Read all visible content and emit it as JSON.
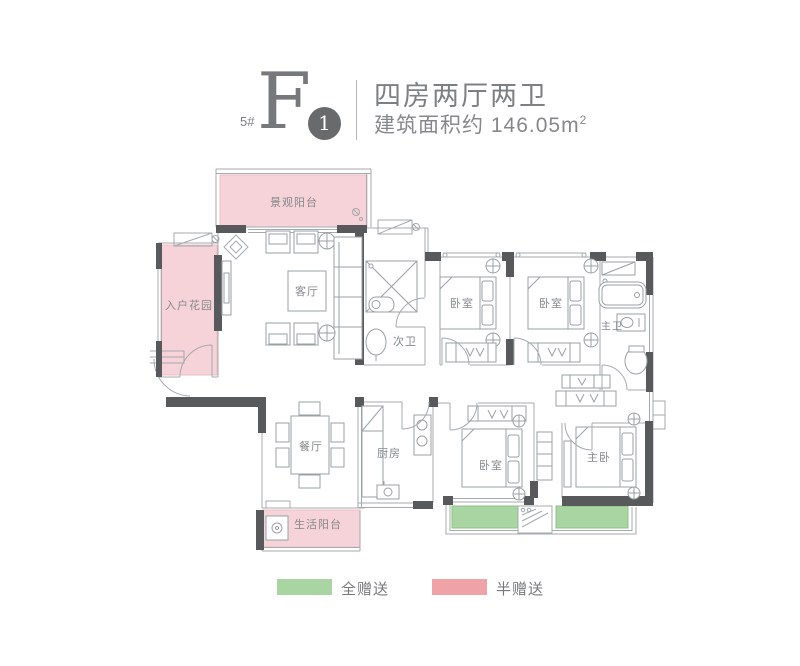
{
  "header": {
    "block": "5#",
    "unit": "F",
    "unit_badge": "1",
    "title": "四房两厅两卫",
    "area_label": "建筑面积约 146.05m",
    "area_sup": "2"
  },
  "plan": {
    "rooms": [
      {
        "label": "景观阳台"
      },
      {
        "label": "入户花园"
      },
      {
        "label": "客厅"
      },
      {
        "label": "次卫"
      },
      {
        "label": "卧室"
      },
      {
        "label": "卧室"
      },
      {
        "label": "主卫"
      },
      {
        "label": "餐厅"
      },
      {
        "label": "厨房"
      },
      {
        "label": "卧室"
      },
      {
        "label": "主卧"
      },
      {
        "label": "生活阳台"
      }
    ]
  },
  "legend": {
    "items": [
      {
        "label": "全赠送",
        "color": "#a9d5a2"
      },
      {
        "label": "半赠送",
        "color": "#efa3a6"
      }
    ]
  },
  "colors": {
    "half_gift_fill": "#f6d3d8",
    "full_gift_fill": "#a9d5a2",
    "wall": "#58595b",
    "line": "#a5aaae",
    "text": "#85888b"
  }
}
